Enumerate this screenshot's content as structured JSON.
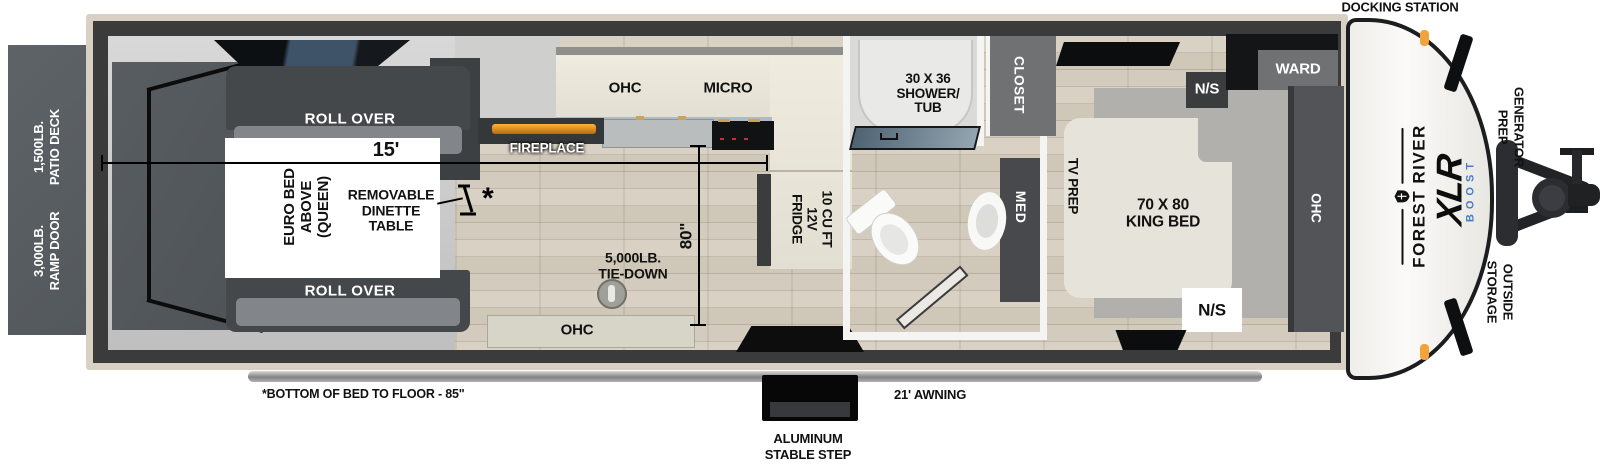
{
  "exterior": {
    "docking_station": "DOCKING STATION",
    "generator_prep": "GENERATOR\nPREP",
    "outside_storage": "OUTSIDE\nSTORAGE",
    "patio_deck": "1,500LB.\nPATIO DECK",
    "ramp_door": "3,000LB.\nRAMP DOOR",
    "awning": "21' AWNING",
    "step": "ALUMINUM\nSTABLE STEP",
    "bed_height_note": "*BOTTOM OF BED TO FLOOR - 85\""
  },
  "branding": {
    "manufacturer": "FOREST RIVER",
    "series": "XLR",
    "series_sub": "BOOST",
    "series_sub_color": "#4a7bc8",
    "marker_light_color": "#f2a43b",
    "fireplace_glow_color": "#f0a030"
  },
  "garage": {
    "sofa_top_label": "ROLL OVER",
    "sofa_bottom_label": "ROLL OVER",
    "euro_bed_label": "EURO BED\nABOVE\n(QUEEN)",
    "dinette_label": "REMOVABLE\nDINETTE\nTABLE",
    "dinette_marker": "*",
    "length_dimension": "15'",
    "height_dimension": "80\"",
    "tie_down_label": "5,000LB.\nTIE-DOWN"
  },
  "kitchen": {
    "ohc_label": "OHC",
    "micro_label": "MICRO",
    "fireplace_label": "FIREPLACE",
    "fridge_label": "10 CU FT\n12V\nFRIDGE",
    "ohc_bottom_label": "OHC"
  },
  "bathroom": {
    "shower_label": "30 X 36\nSHOWER/\nTUB",
    "med_label": "MED",
    "closet_label": "CLOSET"
  },
  "bedroom": {
    "tv_prep_label": "TV PREP",
    "bed_label": "70 X 80\nKING BED",
    "nightstand_top_label": "N/S",
    "nightstand_bottom_label": "N/S",
    "wardrobe_label": "WARD",
    "ohc_label": "OHC"
  }
}
